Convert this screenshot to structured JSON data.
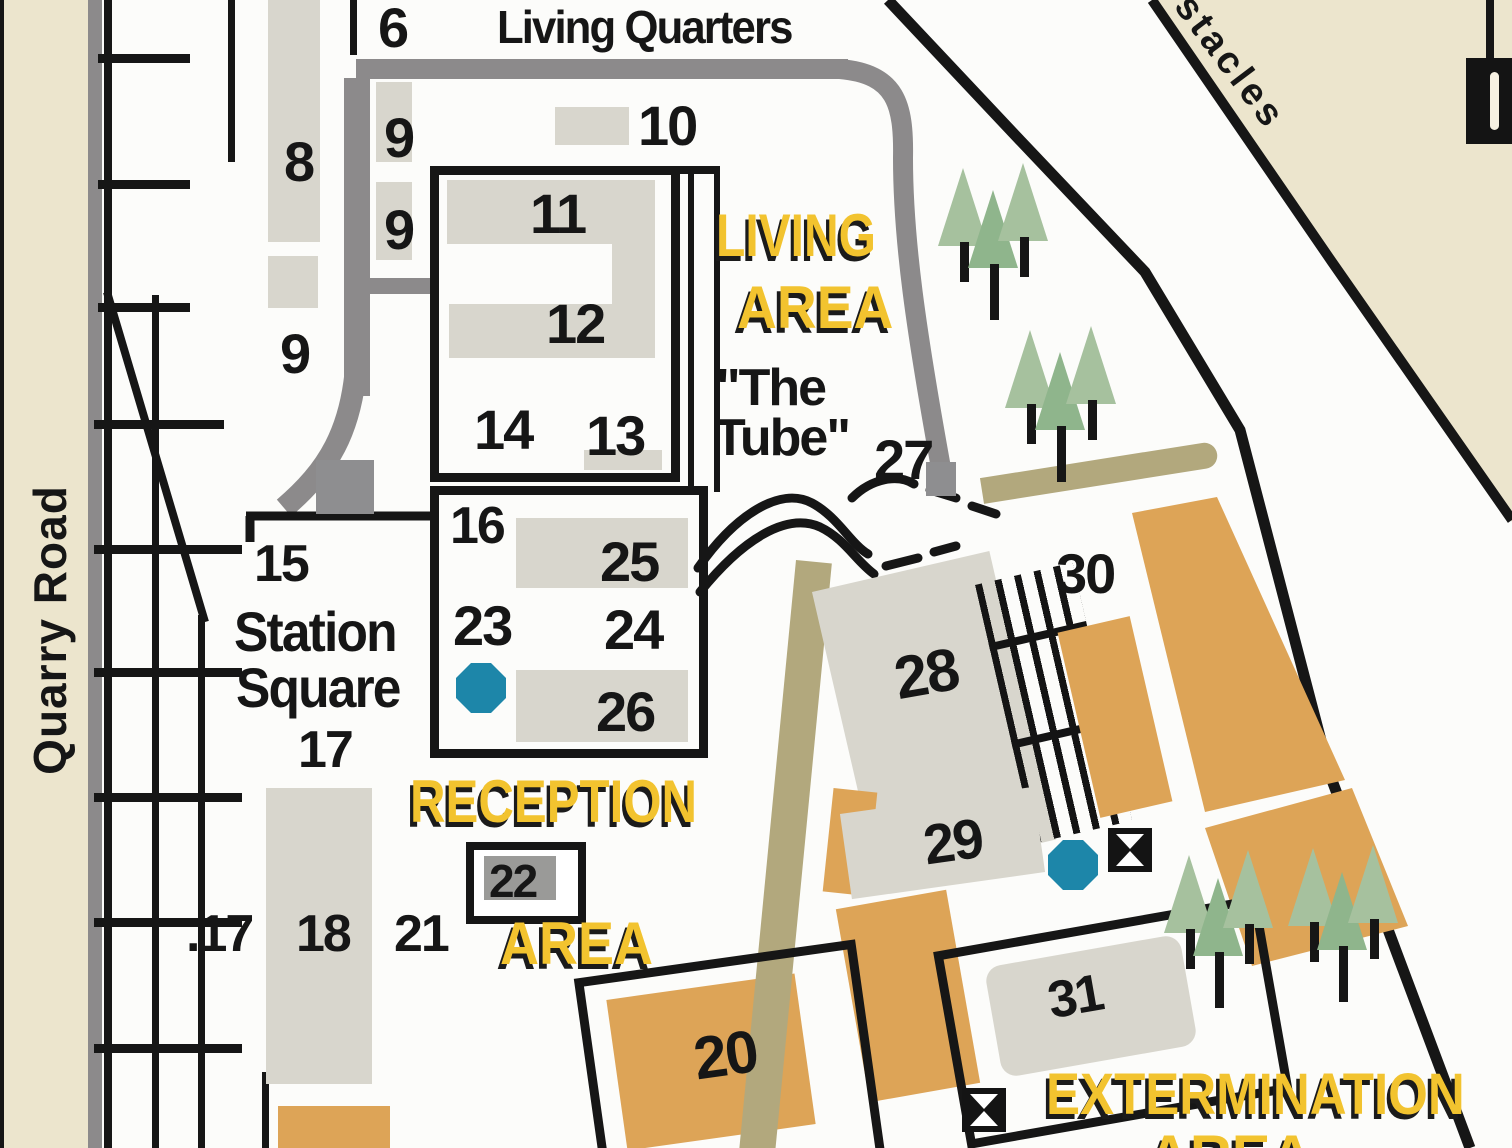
{
  "title": "paintball park site map",
  "roads": {
    "quarry_road_label": "Quarry Road",
    "obstacles_label": "stacles"
  },
  "areas": {
    "living_quarters": "Living Quarters",
    "living_area_line1": "LIVING",
    "living_area_line2": "AREA",
    "tube_line1": "\"The",
    "tube_line2": "Tube\"",
    "station_square_line1": "Station",
    "station_square_line2": "Square",
    "reception_line1": "RECEPTION",
    "reception_line2": "AREA",
    "extermination_line1": "EXTERMINATION",
    "extermination_line2": "AREA"
  },
  "buildings": {
    "n6": "6",
    "n8": "8",
    "n9a": "9",
    "n9b": "9",
    "n9c": "9",
    "n10": "10",
    "n11": "11",
    "n12": "12",
    "n13": "13",
    "n14": "14",
    "n15": "15",
    "n16": "16",
    "n17": "17",
    "n17b": ".17",
    "n18": "18",
    "n20": "20",
    "n21": "21",
    "n22": "22",
    "n23": "23",
    "n24": "24",
    "n25": "25",
    "n26": "26",
    "n27": "27",
    "n28": "28",
    "n29": "29",
    "n30": "30",
    "n31": "31"
  },
  "icons": {
    "blue_octagon_marker": "stop-octagon",
    "hourglass_flag_marker": "hourglass-flag",
    "pine_tree": "pine-tree"
  },
  "colors": {
    "building_gray": "#d8d6cd",
    "building_orange": "#dda457",
    "road_gray": "#8c8a8b",
    "road_beige": "#ece5cd",
    "road_tan": "#b2a87d",
    "tree_green": "#a6c19e",
    "marker_blue": "#1d86a9",
    "label_yellow": "#f2c32f",
    "line_black": "#161616"
  }
}
